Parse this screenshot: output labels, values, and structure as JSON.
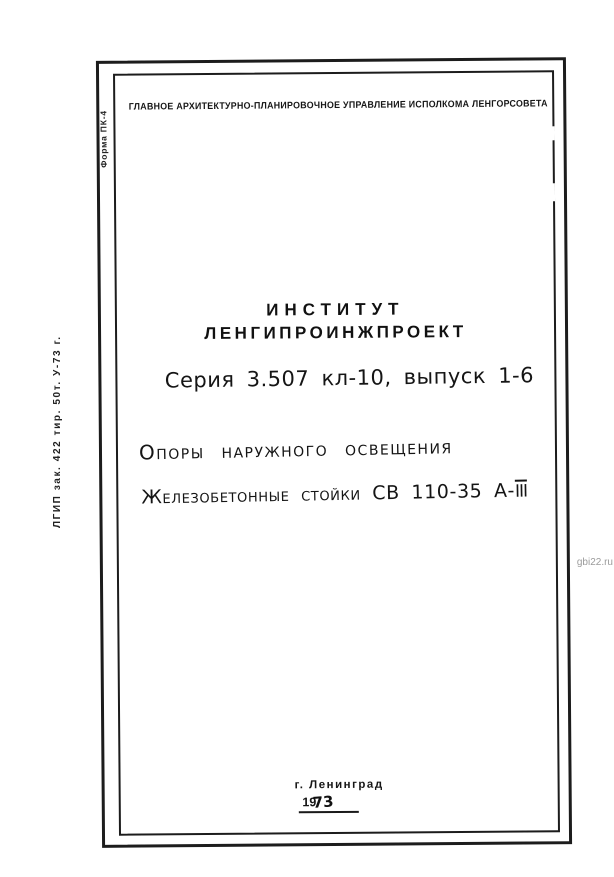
{
  "colors": {
    "paper": "#ffffff",
    "ink": "#1a1a1a",
    "watermark_gray": "#9b9b9b"
  },
  "watermark": {
    "text": "gbi22.ru"
  },
  "margin_marks": {
    "print_code": "ЛГИП зак. 422 тир. 50т. У-73 г.",
    "form_number": "Форма ПК-4"
  },
  "header": {
    "organization": "ГЛАВНОЕ АРХИТЕКТУРНО-ПЛАНИРОВОЧНОЕ УПРАВЛЕНИЕ ИСПОЛКОМА ЛЕНГОРСОВЕТА"
  },
  "institute": {
    "line1": "ИНСТИТУТ",
    "line2": "ЛЕНГИПРОИНЖПРОЕКТ"
  },
  "series": {
    "text": "Серия 3.507 кл-10, выпуск 1-6"
  },
  "title": {
    "line1": "Опоры наружного освещения",
    "line2_prefix": "Железобетонные стойки СВ 110-35 А-",
    "line2_roman": "III"
  },
  "footer": {
    "city": "г. Ленинград",
    "year_printed": "19",
    "year_handwritten": "73"
  }
}
